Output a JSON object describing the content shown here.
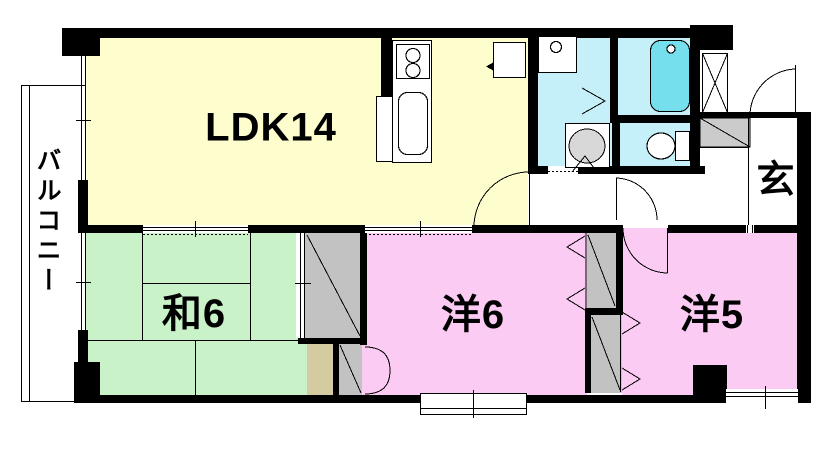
{
  "plan_title": "apartment-floor-plan",
  "colors": {
    "ldk": "#FDFDCE",
    "tatami": "#C9F2C9",
    "western": "#FBCBF3",
    "wet": "#C5F0FA",
    "tub": "#76DFEE",
    "closet": "#C2C2C2",
    "storage": "#D5CBA0",
    "step": "#CBCBCB",
    "wall": "#000000"
  },
  "rooms": {
    "balcony": {
      "label": "バルコニー"
    },
    "ldk": {
      "label": "LDK14"
    },
    "japanese_room": {
      "label": "和6"
    },
    "western_room_6": {
      "label": "洋6"
    },
    "western_room_5": {
      "label": "洋5"
    },
    "entrance": {
      "label": "玄"
    }
  }
}
